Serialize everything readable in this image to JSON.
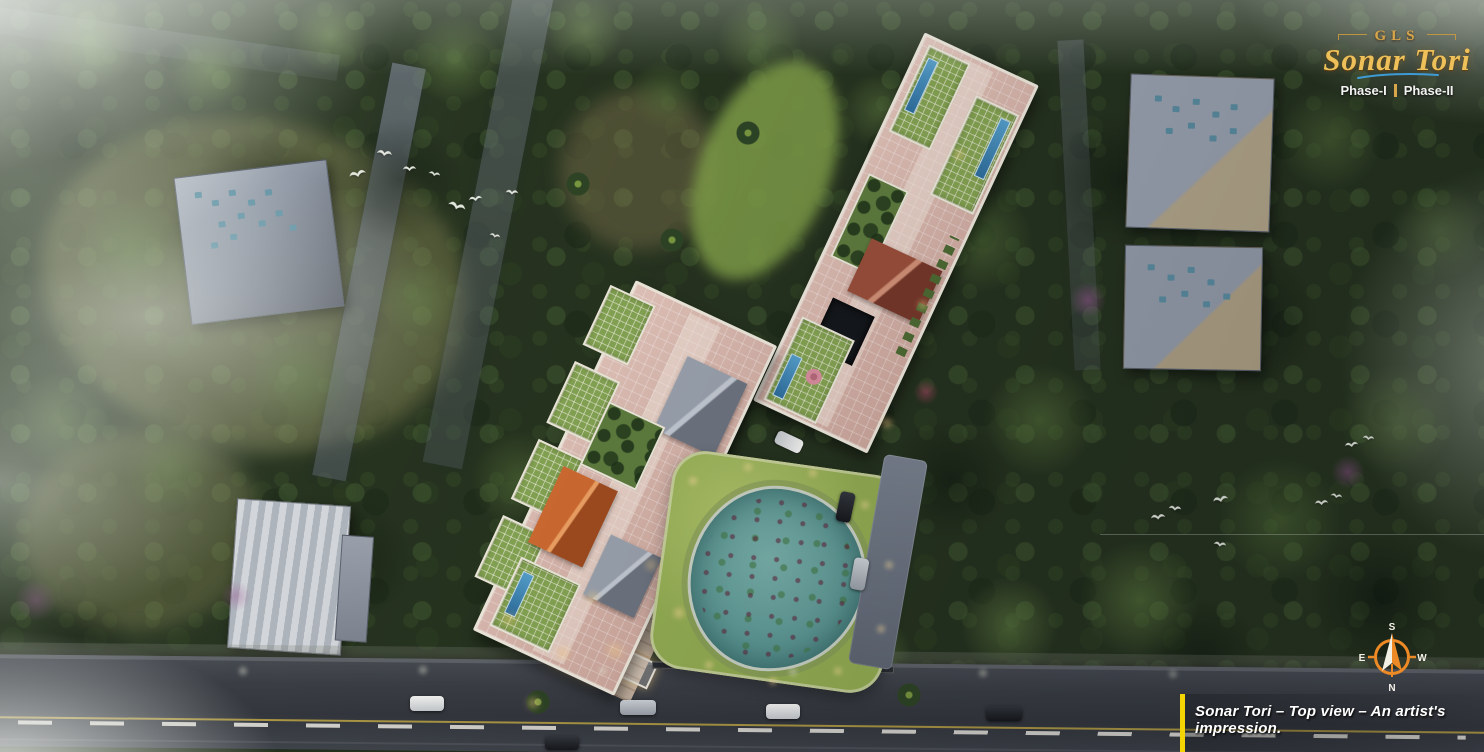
{
  "branding": {
    "company": "GLS",
    "project": "Sonar Tori",
    "phase_1": "Phase-I",
    "phase_2": "Phase-II"
  },
  "compass": {
    "top": "S",
    "bottom": "N",
    "left": "E",
    "right": "W"
  },
  "caption": "Sonar Tori – Top view – An artist's impression.",
  "colors": {
    "logo_gold": "#d8a64a",
    "script_gold": "#eec05a",
    "swoosh_blue": "#3e9bd6",
    "phase_text_white": "#f2f2f2",
    "phase_divider_gold": "#d8a64a",
    "compass_orange": "#ee8a25",
    "compass_letter_white": "#f4f2e8",
    "caption_text_white": "#ffffff",
    "caption_bar_yellow": "#f4d503",
    "pond_teal": "#68a39e",
    "lawn_green": "#98b255",
    "roof_pink": "#d8b6ab",
    "parapet_white": "#efe9dd",
    "forest_green": "#26331f",
    "road_asphalt": "#3c4046"
  }
}
